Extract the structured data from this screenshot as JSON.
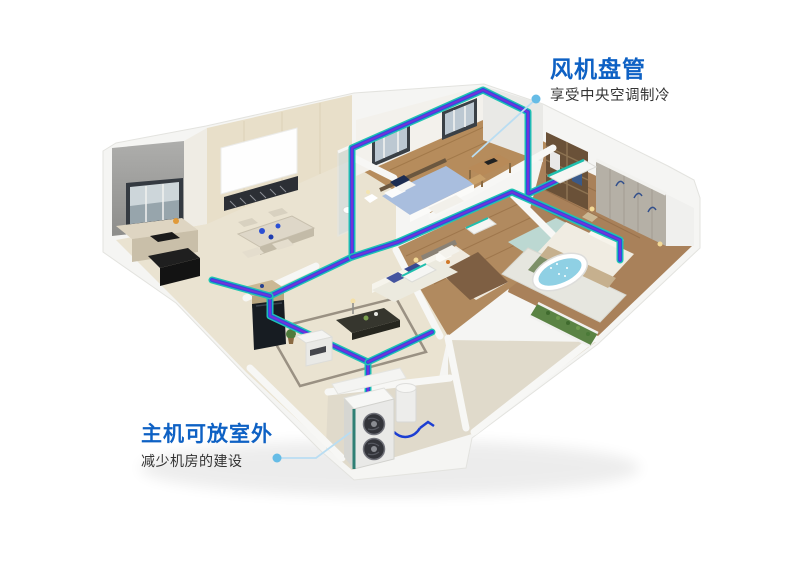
{
  "page": {
    "width": 800,
    "height": 574,
    "background": "#ffffff"
  },
  "callouts": {
    "fan_coil": {
      "title": "风机盘管",
      "subtitle": "享受中央空调制冷"
    },
    "host_unit": {
      "title": "主机可放室外",
      "subtitle": "减少机房的建设"
    }
  },
  "colors": {
    "callout_title": "#0e61c4",
    "callout_subtitle": "#333333",
    "leader_line": "#b9ddf2",
    "leader_dot": "#66bce6",
    "pipe_teal": "#1fc4b2",
    "pipe_blue": "#2b50e0",
    "pipe_purple": "#7a2fd6"
  },
  "scene": {
    "type": "isometric-apartment-cutaway-render",
    "elements": [
      "kitchen",
      "dining-area",
      "projection-screen",
      "blue-bedroom",
      "study-desk",
      "wardrobe",
      "guest-bedroom",
      "master-bedroom",
      "bathtub",
      "living-room",
      "tv-panel",
      "sofa",
      "coffee-table",
      "indoor-fan-coil-units",
      "refrigerant-pipe-runs",
      "outdoor-host-unit",
      "buffer-tank",
      "planter",
      "balcony-pad"
    ]
  }
}
